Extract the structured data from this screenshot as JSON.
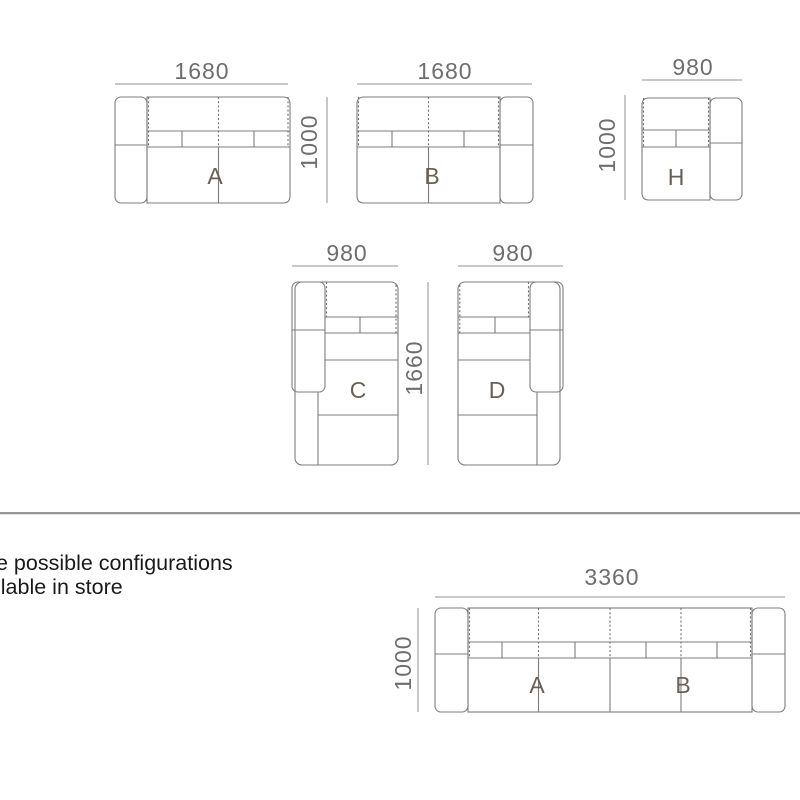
{
  "caption": {
    "line1": "e possible configurations",
    "line2": "ilable in store"
  },
  "diagrams": {
    "module_a": {
      "label": "A",
      "width_mm": "1680",
      "depth_mm": "1000"
    },
    "module_b": {
      "label": "B",
      "width_mm": "1680"
    },
    "module_h": {
      "label": "H",
      "width_mm": "980",
      "depth_mm": "1000"
    },
    "module_c": {
      "label": "C",
      "width_mm": "980",
      "length_mm": "1660"
    },
    "module_d": {
      "label": "D",
      "width_mm": "980"
    },
    "config_ab": {
      "label_left": "A",
      "label_right": "B",
      "width_mm": "3360",
      "depth_mm": "1000"
    }
  },
  "colors": {
    "outline": "#7d7d7d",
    "dashed": "#6f6f6f",
    "dimension_line": "#909090",
    "dimension_text": "#6e6e6e",
    "module_label": "#6b5f55",
    "caption_text": "#1a1a1a",
    "divider": "#979797"
  }
}
